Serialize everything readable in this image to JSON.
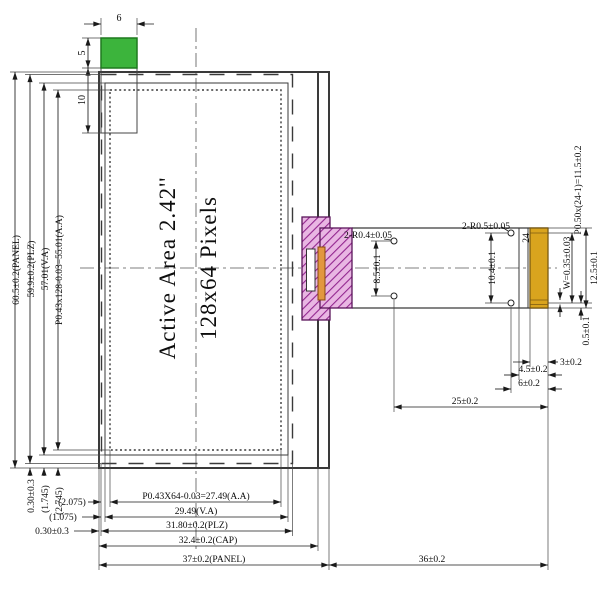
{
  "display": {
    "active_area_label": "Active Area 2.42''",
    "resolution_label": "128x64 Pixels"
  },
  "front_view_dims": {
    "height_panel": "60.5±0.2(PANEL)",
    "height_plz": "59.9±0.2(PLZ)",
    "height_va": "57.01(V.A)",
    "height_aa": "P0.43x128-0.03=55.01(A.A)",
    "bottom_gap_plz": "0.30±0.3",
    "bottom_gap_va": "(1.745)",
    "bottom_gap_aa": "(2.745)",
    "width_aa": "P0.43X64-0.03=27.49(A.A)",
    "width_va": "29.49(V.A)",
    "width_plz": "31.80±0.2(PLZ)",
    "width_cap": "32.4±0.2(CAP)",
    "width_panel": "37±0.2(PANEL)",
    "left_gap_aa": "(2.075)",
    "left_gap_va": "(1.075)",
    "left_gap_plz": "0.30±0.3",
    "tab_width": "6",
    "tab_height": "5",
    "tab_depth": "10"
  },
  "fpc_dims": {
    "holes_left": "2-R0.4±0.05",
    "holes_right": "2-R0.5±0.05",
    "holes_left_spacing": "8.5±0.1",
    "holes_right_spacing": "10.4±0.1",
    "pin_count": "24",
    "pin_pitch": "P0.50x(24-1)=11.5±0.2",
    "pin_width": "W=0.35±0.03",
    "connector_width": "12.5±0.1",
    "pin_edge_offset": "0.5±0.1",
    "stiffener_3": "3±0.2",
    "stiffener_45": "4.5±0.2",
    "stiffener_6": "6±0.2",
    "hole_to_end": "25±0.2",
    "fpc_length": "36±0.2"
  },
  "colors": {
    "tab_green": "#3cb43c",
    "tab_green_border": "#1e7a1e",
    "section_purple_base": "#e9b6e3",
    "section_purple_hatch": "#93278f",
    "section_purple_border": "#5a155a",
    "adhesive_orange": "#e2973f",
    "gold_finger": "#d9a41e",
    "gold_border": "#7a5a12"
  }
}
